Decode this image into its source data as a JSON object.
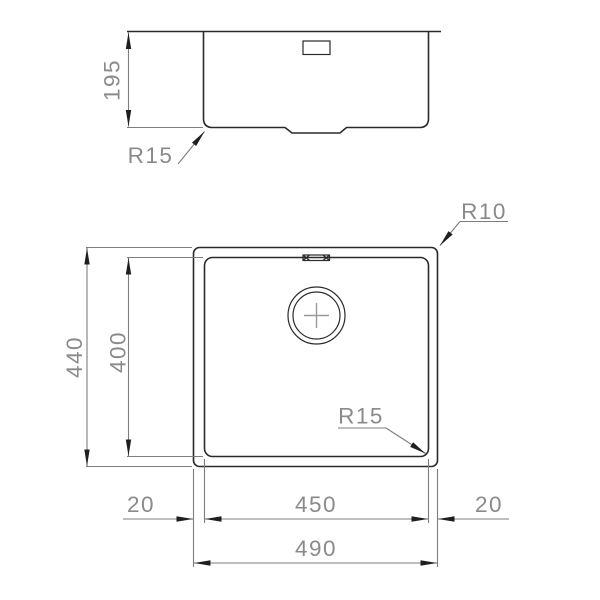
{
  "colors": {
    "background": "#ffffff",
    "object_line": "#2a2a2a",
    "dimension_line": "#7d7d7d",
    "dimension_text": "#8a8a8a",
    "centerline_cross": "#9a9a9a",
    "arrowhead": "#1f1f1f"
  },
  "side_view": {
    "labels": {
      "depth": "195",
      "bottom_corner_radius": "R15"
    }
  },
  "plan_view": {
    "labels": {
      "outer_height": "440",
      "inner_height": "400",
      "inner_width": "450",
      "outer_width": "490",
      "left_margin": "20",
      "right_margin": "20",
      "outer_corner_radius": "R10",
      "inner_corner_radius": "R15"
    }
  }
}
